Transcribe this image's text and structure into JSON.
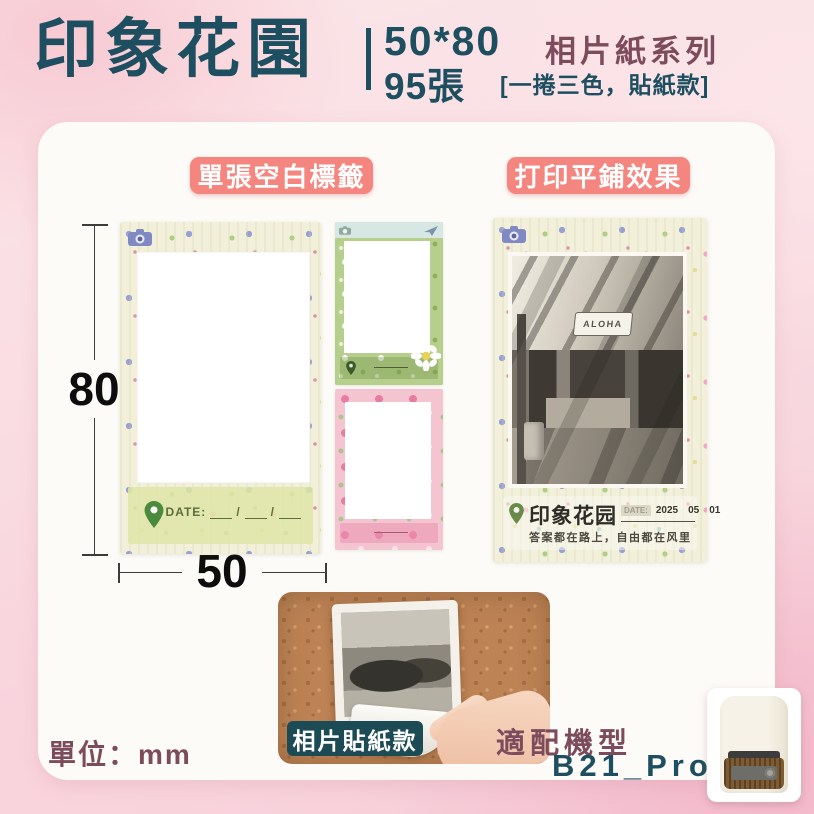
{
  "header": {
    "title": "印象花園",
    "size": "50*80",
    "count": "95張",
    "series": "相片紙系列",
    "variant": "[一捲三色，貼紙款]"
  },
  "sections": {
    "blank_label": {
      "badge": "單張空白標籤",
      "height_mm": "80",
      "width_mm": "50",
      "date_label": "DATE:",
      "date_slash": "/"
    },
    "print_effect": {
      "badge": "打印平鋪效果",
      "shop_sign": "ALOHA",
      "brand": "印象花园",
      "date_label": "DATE:",
      "date_year": "2025",
      "date_month": "05",
      "date_day": "01",
      "tagline": "答案都在路上，自由都在风里"
    },
    "sticker_demo": {
      "badge": "相片貼紙款"
    },
    "footer": {
      "unit": "單位：mm",
      "compat_label": "適配機型",
      "model": "B21_Pro"
    }
  },
  "colors": {
    "teal": "#1d4f60",
    "plum": "#7c4b5c",
    "badge_pink": "#f5867f",
    "badge_teal": "#1d4b55",
    "card": "#fdfbf8"
  }
}
